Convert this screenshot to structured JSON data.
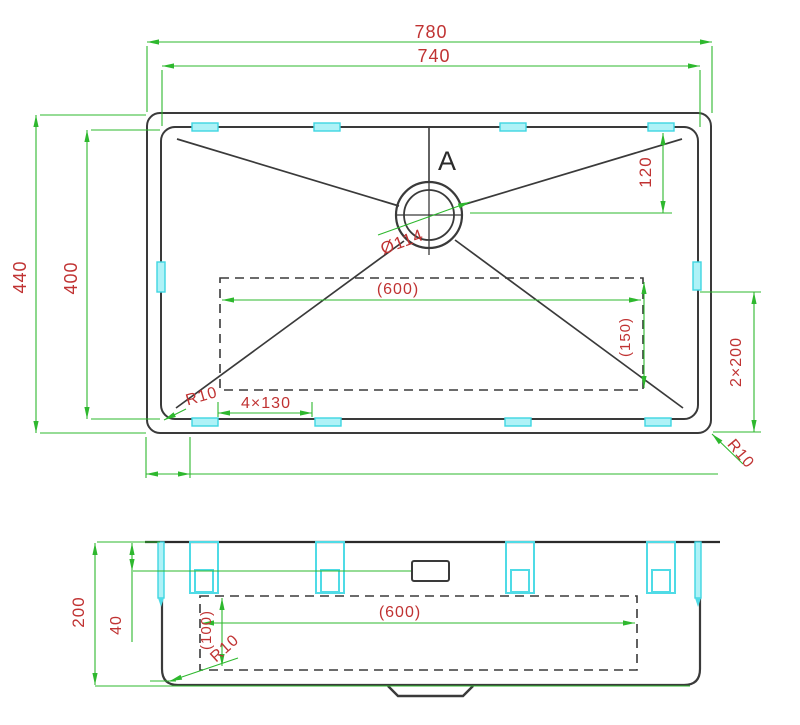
{
  "colors": {
    "dimension_green": "#2eb82e",
    "annotation_red": "#c03232",
    "outline_black": "#3a3a3a",
    "clip_cyan": "#4fdbe6",
    "background": "#ffffff"
  },
  "top_view": {
    "width_overall": "780",
    "width_inner": "740",
    "height_overall": "440",
    "height_inner": "400",
    "drain_offset": "120",
    "drain_diameter": "Ø114",
    "section_label": "A",
    "base_width": "(600)",
    "base_depth": "(150)",
    "side_clip_spacing": "2×200",
    "bottom_clip_spacing": "4×130",
    "radius_bottom_left": "R10",
    "radius_bottom_right": "R10"
  },
  "side_view": {
    "height_overall": "200",
    "rim_depth": "40",
    "base_width": "(600)",
    "base_clearance": "(100)",
    "radius": "R10"
  }
}
